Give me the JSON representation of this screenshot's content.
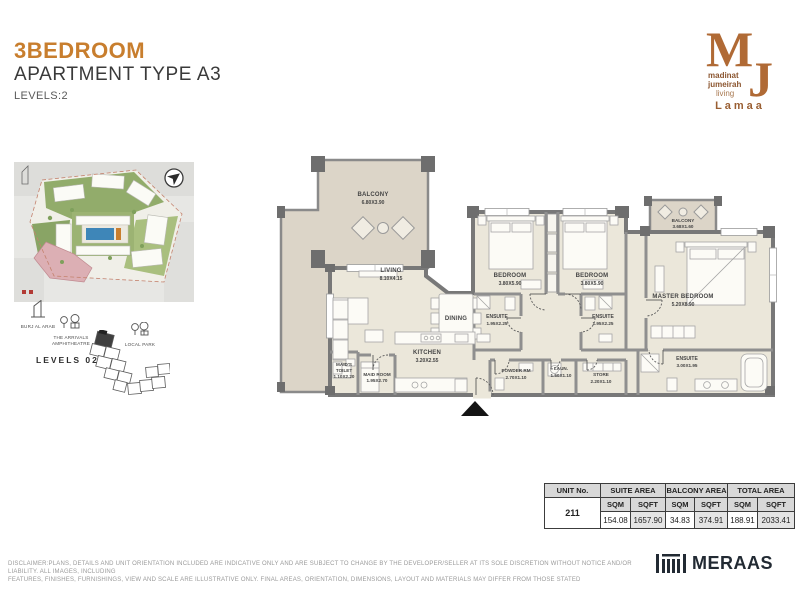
{
  "header": {
    "title": "3BEDROOM",
    "subtitle": "APARTMENT TYPE A3",
    "levels": "LEVELS:2",
    "accent_color": "#C87E2E"
  },
  "brand": {
    "logo_m": "M",
    "logo_j": "J",
    "logo_line1": "madinat",
    "logo_line2": "jumeirah",
    "logo_line3": "living",
    "community": "Lamaa",
    "logo_color": "#B06A35"
  },
  "location": {
    "landmark_burj": "BURJ AL ARAB",
    "landmark_amphitheatre": "THE ARRIVALS AMPHITHEATRE",
    "landmark_park": "LOCAL PARK",
    "level_label": "LEVELS 02"
  },
  "plan": {
    "rooms": {
      "balcony_main": {
        "name": "BALCONY",
        "dims": "6.80X3.90"
      },
      "living": {
        "name": "LIVING",
        "dims": "8.10X4.15"
      },
      "dining": {
        "name": "DINING"
      },
      "kitchen": {
        "name": "KITCHEN",
        "dims": "3.20X2.55"
      },
      "maids_toilet": {
        "name1": "MAID'S",
        "name2": "TOILET",
        "dims": "1.10X2.20"
      },
      "maid_room": {
        "name": "MAID ROOM",
        "dims": "1.95X2.70"
      },
      "bedroom1": {
        "name": "BEDROOM",
        "dims": "3.80X5.90"
      },
      "ensuite1": {
        "name": "ENSUITE",
        "dims": "1.95X2.25"
      },
      "bedroom2": {
        "name": "BEDROOM",
        "dims": "3.80X5.90"
      },
      "ensuite2": {
        "name": "ENSUITE",
        "dims": "1.95X2.25"
      },
      "master": {
        "name": "MASTER BEDROOM",
        "dims": "5.20X8.90"
      },
      "master_ensuite": {
        "name": "ENSUITE",
        "dims": "3.00X1.95"
      },
      "balcony2": {
        "name": "BALCONY",
        "dims": "3.68X1.60"
      },
      "powder": {
        "name": "POWDER RM",
        "dims": "2.70X1.10"
      },
      "laundry": {
        "name": "LAUN.",
        "dims": "1.50X1.10"
      },
      "store": {
        "name": "STORE",
        "dims": "2.20X1.10"
      }
    }
  },
  "area_table": {
    "col_unit": "UNIT No.",
    "col_suite": "SUITE AREA",
    "col_balcony": "BALCONY AREA",
    "col_total": "TOTAL AREA",
    "sqm": "SQM",
    "sqft": "SQFT",
    "unit_no": "211",
    "suite_sqm": "154.08",
    "suite_sqft": "1657.90",
    "balcony_sqm": "34.83",
    "balcony_sqft": "374.91",
    "total_sqm": "188.91",
    "total_sqft": "2033.41"
  },
  "footer": {
    "disclaimer_line1": "DISCLAIMER:PLANS, DETAILS AND UNIT ORIENTATION INCLUDED ARE INDICATIVE ONLY AND ARE SUBJECT TO CHANGE BY THE DEVELOPER/SELLER AT ITS SOLE DISCRETION WITHOUT NOTICE AND/OR LIABILITY. ALL IMAGES, INCLUDING",
    "disclaimer_line2": "FEATURES, FINISHES, FURNISHINGS, VIEW AND SCALE ARE ILLUSTRATIVE ONLY. FINAL AREAS, ORIENTATION, DIMENSIONS, LAYOUT AND MATERIALS MAY DIFFER FROM THOSE STATED",
    "developer": "MERAAS"
  }
}
